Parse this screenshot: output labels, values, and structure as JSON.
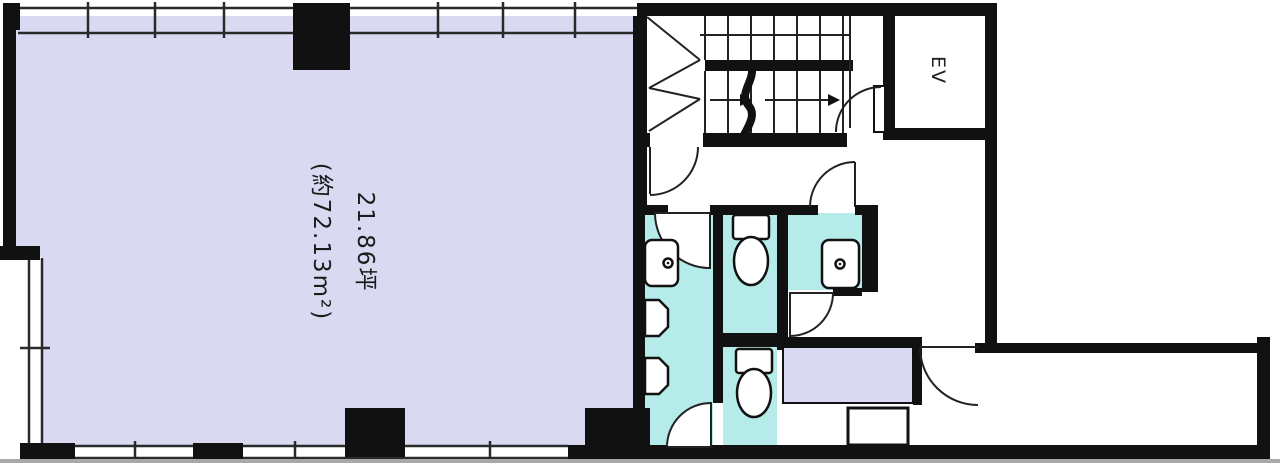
{
  "plan": {
    "area_label": {
      "line1": "21.86坪",
      "line2": "(約72.13m²)"
    },
    "elevator_label": "EV",
    "colors": {
      "room_fill": "#d9daf2",
      "wet_area_fill": "#b5ebe9",
      "counter_fill": "#d9daf2",
      "wall": "#111111",
      "line": "#222222",
      "background": "#ffffff"
    },
    "features": [
      "main-room",
      "staircase",
      "elevator",
      "corridor",
      "restrooms",
      "toilet-stalls",
      "kitchenette",
      "service-strip"
    ],
    "fixtures": [
      "toilet",
      "sink",
      "urinal",
      "kitchen-sink",
      "counter"
    ]
  }
}
